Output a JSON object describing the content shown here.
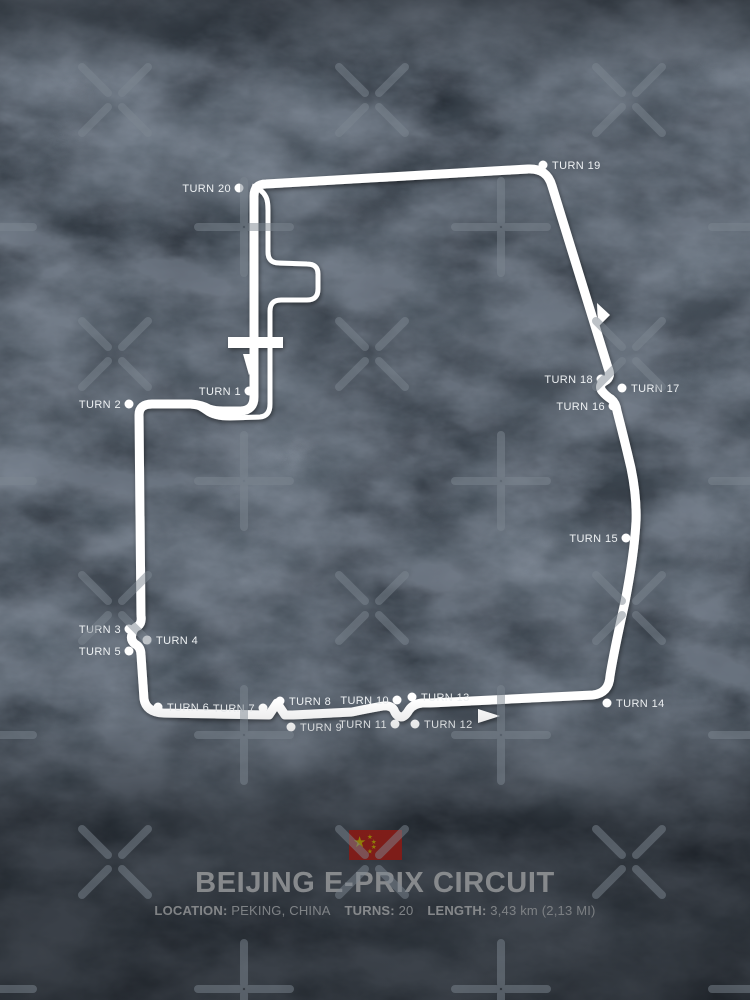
{
  "poster": {
    "title": "BEIJING E-PRIX CIRCUIT",
    "info": [
      {
        "label": "LOCATION:",
        "value": "PEKING, CHINA"
      },
      {
        "label": "TURNS:",
        "value": "20"
      },
      {
        "label": "LENGTH:",
        "value": "3,43 km (2,13 MI)"
      }
    ],
    "flag_name": "flag-of-china"
  },
  "colors": {
    "background": "#20262e",
    "track": "#ffffff",
    "label_text": "#eef1f3",
    "watermark": "#7b8590",
    "flag_red": "#e02a1f",
    "flag_yellow": "#ffde00"
  },
  "diagram": {
    "track_path": "M 254 196 Q 254 184 266 184 L 528 169 Q 547 168 552 186 L 608 368 Q 612 377 605 381 Q 598 385 602 391 Q 606 396 611 399 Q 616 403 617 411 Q 624 438 631 468 Q 637 497 636 522 Q 634 556 625 602 Q 614 651 610 676 Q 609 693 593 695 L 430 703 L 422 703 Q 413 704 409 710 Q 405 717 401 717 Q 396 716 394 710 Q 391 705 383 706 Q 366 709 352 712 L 293 715 L 285 715 L 277 703 L 269 715 L 163 713 Q 146 712 144 699 L 141 655 Q 141 647 135 644 Q 130 640 132 634 Q 133 628 138 626 Q 142 623 141 616 L 139 415 Q 139 404 152 404 L 191 404 Q 202 405 209 409 Q 215 411 223 411 L 241 411 Q 254 410 254 397 Z",
    "pit_path": "M 252 186 Q 262 189 266 197 Q 268 201 268 210 L 268 252 Q 268 263 279 263 L 307 264 Q 318 264 318 274 L 318 289 Q 318 300 307 300 L 281 300 Q 270 300 270 311 L 270 404 Q 270 416 260 417 L 230 418 Q 214 418 206 412 Q 199 407 194 405",
    "start_bar": {
      "x": 228,
      "y": 337,
      "w": 55,
      "h": 11
    },
    "arrows": [
      {
        "name": "start-direction-arrow",
        "points": "243,354 256,354 249,375"
      },
      {
        "name": "right-side-direction-arrow",
        "points": "597,303 610,315 598,327"
      },
      {
        "name": "bottom-direction-arrow",
        "points": "478,709 478,723 500,716"
      }
    ],
    "dot_radius": 4.5,
    "turns": [
      {
        "label": "TURN 1",
        "dot": [
          249,
          391
        ],
        "text": [
          241,
          391
        ],
        "anchor": "end"
      },
      {
        "label": "TURN 2",
        "dot": [
          129,
          404
        ],
        "text": [
          121,
          404
        ],
        "anchor": "end"
      },
      {
        "label": "TURN 3",
        "dot": [
          129,
          629
        ],
        "text": [
          121,
          629
        ],
        "anchor": "end"
      },
      {
        "label": "TURN 4",
        "dot": [
          147,
          640
        ],
        "text": [
          156,
          640
        ],
        "anchor": "start"
      },
      {
        "label": "TURN 5",
        "dot": [
          129,
          651
        ],
        "text": [
          121,
          651
        ],
        "anchor": "end"
      },
      {
        "label": "TURN 6",
        "dot": [
          158,
          707
        ],
        "text": [
          167,
          707
        ],
        "anchor": "start"
      },
      {
        "label": "TURN 7",
        "dot": [
          263,
          708
        ],
        "text": [
          255,
          708
        ],
        "anchor": "end"
      },
      {
        "label": "TURN 8",
        "dot": [
          280,
          701
        ],
        "text": [
          289,
          701
        ],
        "anchor": "start"
      },
      {
        "label": "TURN 9",
        "dot": [
          291,
          727
        ],
        "text": [
          300,
          727
        ],
        "anchor": "start"
      },
      {
        "label": "TURN 10",
        "dot": [
          397,
          700
        ],
        "text": [
          389,
          700
        ],
        "anchor": "end"
      },
      {
        "label": "TURN 11",
        "dot": [
          395,
          724
        ],
        "text": [
          387,
          724
        ],
        "anchor": "end"
      },
      {
        "label": "TURN 12",
        "dot": [
          415,
          724
        ],
        "text": [
          424,
          724
        ],
        "anchor": "start"
      },
      {
        "label": "TURN 13",
        "dot": [
          412,
          697
        ],
        "text": [
          421,
          697
        ],
        "anchor": "start"
      },
      {
        "label": "TURN 14",
        "dot": [
          607,
          703
        ],
        "text": [
          616,
          703
        ],
        "anchor": "start"
      },
      {
        "label": "TURN 15",
        "dot": [
          626,
          538
        ],
        "text": [
          618,
          538
        ],
        "anchor": "end"
      },
      {
        "label": "TURN 16",
        "dot": [
          613,
          406
        ],
        "text": [
          605,
          406
        ],
        "anchor": "end"
      },
      {
        "label": "TURN 17",
        "dot": [
          622,
          388
        ],
        "text": [
          631,
          388
        ],
        "anchor": "start"
      },
      {
        "label": "TURN 18",
        "dot": [
          601,
          379
        ],
        "text": [
          593,
          379
        ],
        "anchor": "end"
      },
      {
        "label": "TURN 19",
        "dot": [
          543,
          165
        ],
        "text": [
          552,
          165
        ],
        "anchor": "start"
      },
      {
        "label": "TURN 20",
        "dot": [
          239,
          188
        ],
        "text": [
          231,
          188
        ],
        "anchor": "end"
      }
    ]
  },
  "watermark": {
    "x_rows_y": [
      100,
      354,
      608,
      862
    ],
    "x_cols": [
      115,
      372,
      629
    ],
    "plus_rows_y": [
      227,
      481,
      735,
      989
    ],
    "plus_cols": [
      -13,
      244,
      501,
      758
    ],
    "arm": 33,
    "gap": 7,
    "plus_arm": 46,
    "plus_gap": 5
  }
}
